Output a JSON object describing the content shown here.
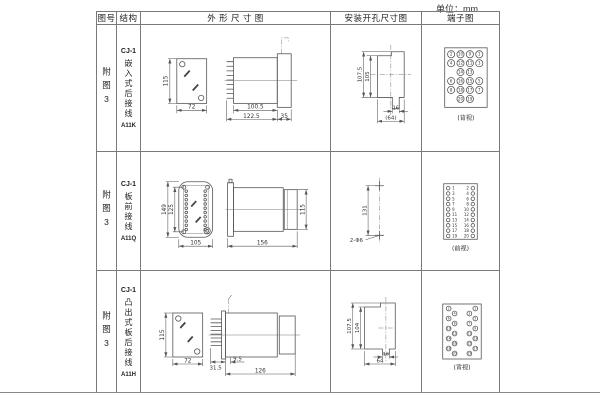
{
  "unit_label": "单位：mm",
  "headers": {
    "fig": "图号",
    "structure": "结构",
    "outline": "外 形 尺 寸 图",
    "mounting": "安装开孔尺寸图",
    "terminal": "端子图"
  },
  "rows": [
    {
      "fig": "附图3",
      "model": "CJ-1",
      "structure": "嵌入式后接线",
      "code": "A11K",
      "outline": {
        "front_h": "115",
        "front_w": "72",
        "body": "100.5",
        "total": "122.5",
        "flange": "35"
      },
      "mounting": {
        "outer": "107.5",
        "inner": "105",
        "notch": "16",
        "width": "(64)"
      },
      "terminal": {
        "caption": "(背视)",
        "grid": [
          [
            "2",
            "10",
            "9",
            "1"
          ],
          [
            "4",
            "12",
            "11",
            "3"
          ],
          [
            "",
            "14",
            "13",
            ""
          ],
          [
            "6",
            "16",
            "15",
            "5"
          ],
          [
            "8",
            "18",
            "17",
            "7"
          ],
          [
            "",
            "20",
            "19",
            ""
          ]
        ]
      }
    },
    {
      "fig": "附图3",
      "model": "CJ-1",
      "structure": "板前接线",
      "code": "A11Q",
      "outline": {
        "outer_h": "149",
        "inner_h": "125",
        "front_w": "105",
        "body_len": "156",
        "body_h": "115"
      },
      "mounting": {
        "spacing": "131",
        "holes": "2-Φ6"
      },
      "terminal": {
        "caption": "(前视)",
        "left": [
          "1",
          "3",
          "5",
          "7",
          "9",
          "11",
          "13",
          "15",
          "17",
          "19"
        ],
        "right": [
          "2",
          "4",
          "6",
          "8",
          "10",
          "12",
          "14",
          "16",
          "18",
          "20"
        ]
      }
    },
    {
      "fig": "附图3",
      "model": "CJ-1",
      "structure": "凸出式板后接线",
      "code": "A11H",
      "outline": {
        "front_h": "115",
        "front_w": "72",
        "pin_depth": "31.5",
        "step": "9.5",
        "body_len": "126"
      },
      "mounting": {
        "outer": "107.5",
        "inner": "104",
        "notch": "16",
        "width": "64"
      },
      "terminal": {
        "caption": "(背视)",
        "left": [
          "2",
          "4",
          "6",
          "8",
          "10",
          "12",
          "14",
          "16",
          "18",
          "20"
        ],
        "right": [
          "1",
          "3",
          "5",
          "7",
          "9",
          "11",
          "13",
          "15",
          "17",
          "19"
        ]
      }
    }
  ]
}
